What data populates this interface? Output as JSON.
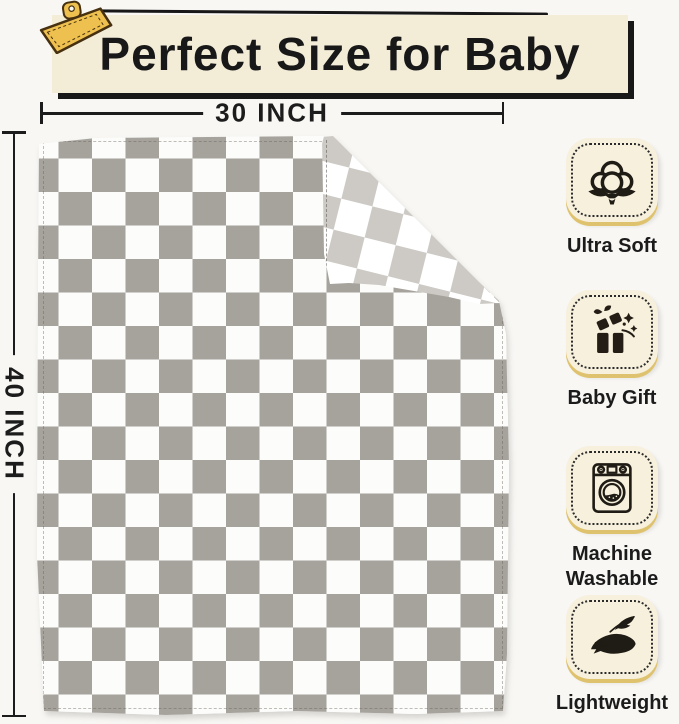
{
  "banner": {
    "title": "Perfect Size for Baby"
  },
  "dimensions": {
    "width_label": "30 INCH",
    "height_label": "40 INCH"
  },
  "features": [
    {
      "icon": "cotton-icon",
      "label": "Ultra Soft"
    },
    {
      "icon": "gift-icon",
      "label": "Baby Gift"
    },
    {
      "icon": "washing-machine-icon",
      "label": "Machine Washable"
    },
    {
      "icon": "feather-icon",
      "label": "Lightweight"
    }
  ],
  "blanket": {
    "pattern": "checkerboard",
    "front_square_color": "#a6a29c",
    "front_alt_color": "#fcfcfb",
    "back_square_color": "#cdcac5",
    "folded_corner": "top-right"
  },
  "colors": {
    "page_background": "#f8f7f4",
    "banner_background": "#f3edd8",
    "banner_shadow": "#181818",
    "badge_background": "#f6f0dc",
    "badge_gold_shadow": "#dfc26d",
    "clip_gold": "#eec04f",
    "text": "#1b1b1b"
  }
}
